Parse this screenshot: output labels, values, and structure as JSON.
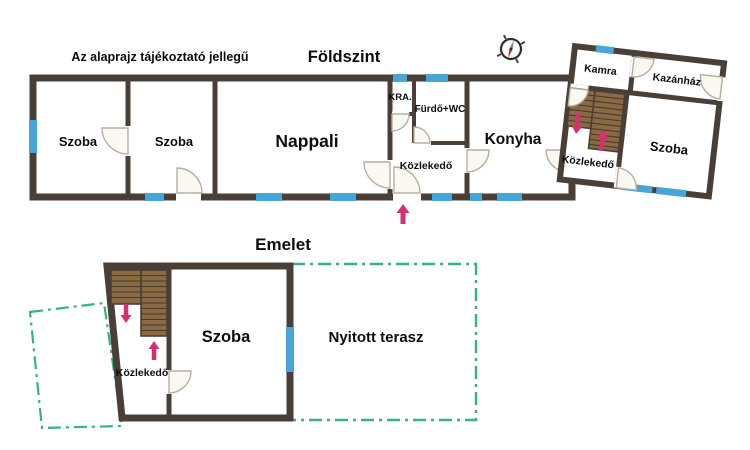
{
  "header": {
    "disclaimer": "Az alaprajz tájékoztató jellegű",
    "ground_floor_title": "Földszint",
    "upper_floor_title": "Emelet"
  },
  "ground_floor": {
    "szoba1": "Szoba",
    "szoba2": "Szoba",
    "nappali": "Nappali",
    "kra": "KRA.",
    "furdo_wc": "Fürdő+WC",
    "kozlekedo": "Közlekedő",
    "konyha": "Konyha",
    "annex": {
      "kamra": "Kamra",
      "kazanhaz": "Kazánház",
      "kozlekedo": "Közlekedő",
      "szoba": "Szoba"
    }
  },
  "upper_floor": {
    "kozlekedo": "Közlekedő",
    "szoba": "Szoba",
    "terasz": "Nyitott terasz"
  },
  "colors": {
    "wall": "#4a3f37",
    "window": "#45a6d7",
    "stairs": "#8a6a44",
    "stair_step_line": "#4a3b2a",
    "arrow": "#d5306f",
    "terrace_outline": "#35b384",
    "door_fill": "#faf8f0",
    "door_stroke": "#b5b0a4",
    "compass_needle": "#c0392b",
    "text": "#0d0d0d",
    "background": "#ffffff"
  }
}
